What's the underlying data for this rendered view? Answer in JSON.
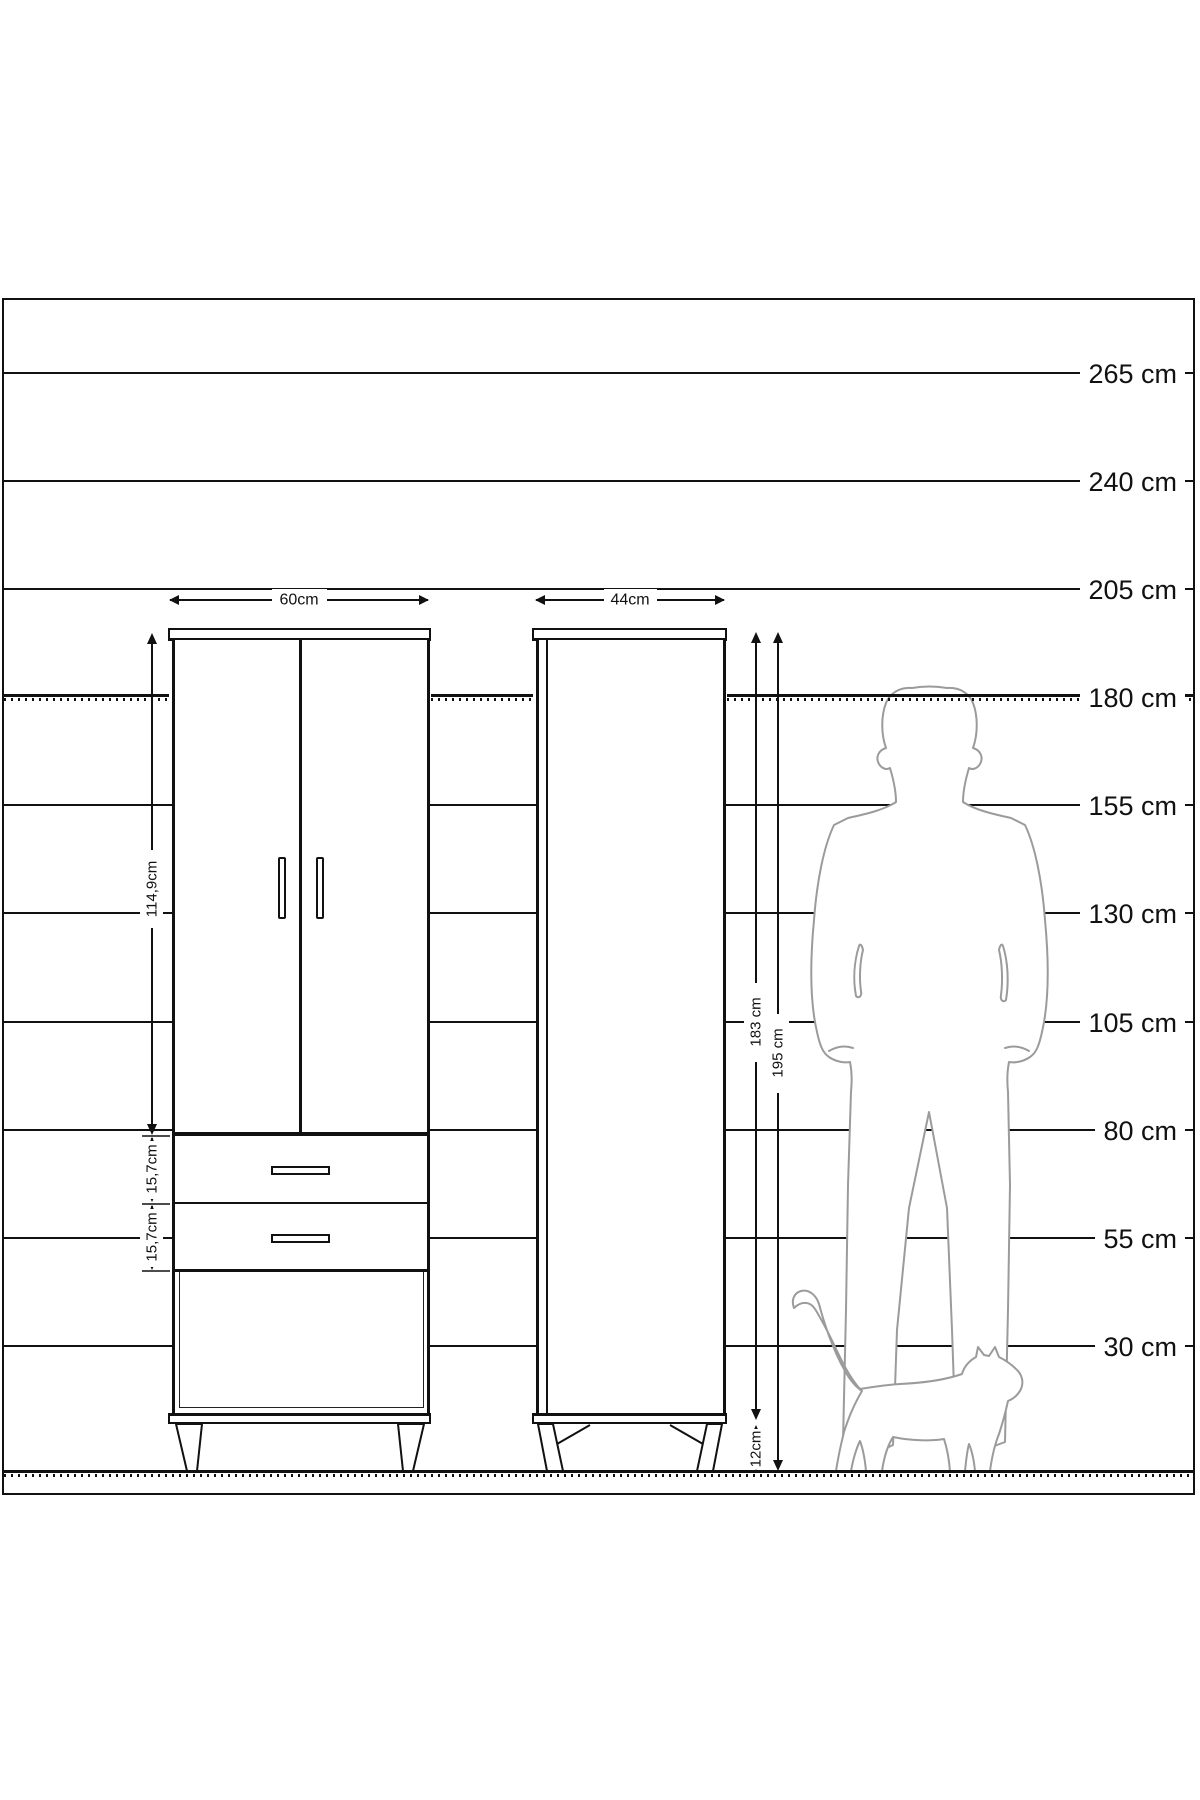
{
  "diagram": {
    "ruler_labels": [
      "265 cm",
      "240 cm",
      "205 cm",
      "180 cm",
      "155 cm",
      "130 cm",
      "105 cm",
      "80 cm",
      "55 cm",
      "30 cm"
    ],
    "front_view": {
      "width": "60cm",
      "door_height": "114,9cm",
      "drawer_height_top": "15,7cm",
      "drawer_height_bottom": "15,7cm"
    },
    "side_view": {
      "depth": "44cm",
      "carcass_height": "183 cm",
      "total_height": "195 cm",
      "leg_height": "12cm"
    },
    "figures": {
      "man_icon": "man-silhouette",
      "cat_icon": "cat-silhouette"
    },
    "colors": {
      "line": "#111111",
      "figure_outline": "#9b9b9b",
      "background": "#ffffff"
    }
  }
}
